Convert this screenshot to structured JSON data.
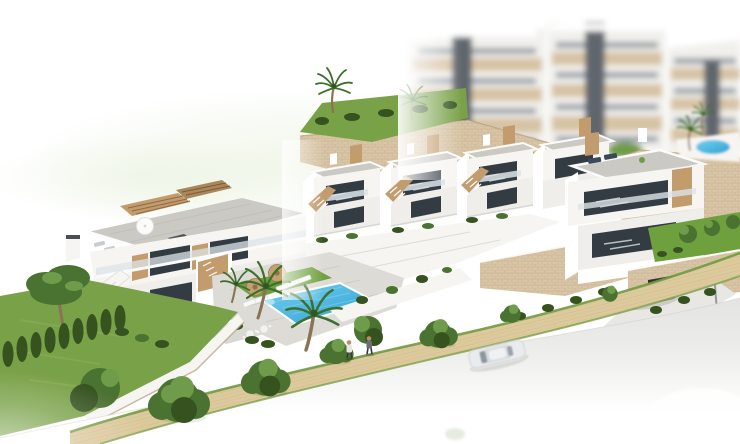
{
  "scene": {
    "type": "architectural-3d-render",
    "view": "aerial three-quarter view",
    "subject": "modern white residential complex on a hillside with communal pool, gardens, street and blurred apartment blocks behind",
    "focus": "foreground buildings sharp, background apartment blocks and street edges fade to white"
  },
  "inventory": {
    "background_apartment_blocks": 3,
    "townhouse_units": 4,
    "villas": 2,
    "swimming_pools": 2,
    "sun_loungers_poolside": 6,
    "pool_parasols": 2,
    "rooftop_parasols": 1,
    "pedestrians": 2,
    "cars": 2,
    "car_descriptions": [
      "white car on street",
      "gray car in driveway"
    ],
    "street_lamps": 1,
    "palm_trees": 7,
    "pine_trees": 1,
    "cypress_hedge_plants": 9,
    "street_trees": 6
  },
  "colors": {
    "white": "#ffffff",
    "facade": "#f6f5f2",
    "facade_shade": "#efeeea",
    "wood": "#c29c6d",
    "wood_dark": "#a9875a",
    "window": "#333c43",
    "glass": "#dce4e7",
    "roof_deck": "#cac9c4",
    "stone": "#d8c6a6",
    "stone_dark": "#b49c78",
    "lawn": "#79a148",
    "lawn_bright": "#6fa03e",
    "hedge": "#35521f",
    "tree": "#4a7231",
    "tree_light": "#6f9c4a",
    "trunk": "#8a7355",
    "palm_frond": "#3e6e2c",
    "pool": "#2aa0d4",
    "pool_light": "#79d0ee",
    "deck": "#dcdbd6",
    "road": "#e4e4e2",
    "walk": "#dcc99c",
    "walk_line": "#c4ae7e",
    "parasol": "#c3a271",
    "car_gray": "#8d939b",
    "car_white": "#e9ecee",
    "metal": "#9599a0",
    "apt_facade": "#f1f0ec",
    "apt_beige": "#d7c3a4",
    "apt_core": "#60666d",
    "apt_window": "#9aa1a8",
    "halo": "#cfe3b8",
    "skin": "#b98e6e"
  }
}
